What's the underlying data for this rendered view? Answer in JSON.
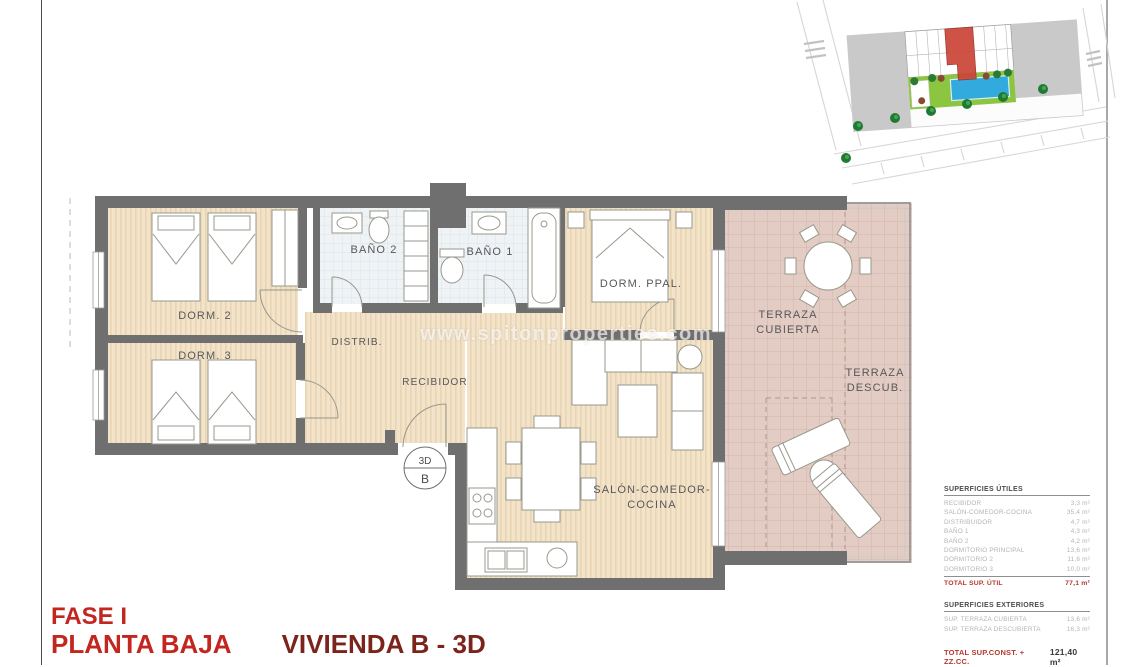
{
  "titles": {
    "fase": "FASE I",
    "planta": "PLANTA BAJA",
    "vivienda": "VIVIENDA B - 3D"
  },
  "watermark": "www.spitonproperties.com",
  "marker": {
    "top": "3D",
    "bottom": "B"
  },
  "rooms": {
    "dorm2": "DORM. 2",
    "dorm3": "DORM. 3",
    "bano2": "BAÑO 2",
    "bano1": "BAÑO 1",
    "dorm_ppal": "DORM. PPAL.",
    "distrib": "DISTRIB.",
    "recibidor": "RECIBIDOR",
    "salon1": "SALÓN-COMEDOR-",
    "salon2": "COCINA",
    "terraza_cubierta1": "TERRAZA",
    "terraza_cubierta2": "CUBIERTA",
    "terraza_descub1": "TERRAZA",
    "terraza_descub2": "DESCUB."
  },
  "areas": {
    "utiles_title": "SUPERFICIES ÚTILES",
    "utiles": [
      {
        "label": "RECIBIDOR",
        "value": "3,3 m²"
      },
      {
        "label": "SALÓN-COMEDOR-COCINA",
        "value": "35,4 m²"
      },
      {
        "label": "DISTRIBUIDOR",
        "value": "4,7 m²"
      },
      {
        "label": "BAÑO 1",
        "value": "4,3 m²"
      },
      {
        "label": "BAÑO 2",
        "value": "4,2 m²"
      },
      {
        "label": "DORMITORIO PRINCIPAL",
        "value": "13,6 m²"
      },
      {
        "label": "DORMITORIO 2",
        "value": "11,6 m²"
      },
      {
        "label": "DORMITORIO 3",
        "value": "10,0 m²"
      }
    ],
    "total_util_label": "TOTAL SUP. ÚTIL",
    "total_util_value": "77,1 m²",
    "exteriores_title": "SUPERFICIES EXTERIORES",
    "exteriores": [
      {
        "label": "SUP. TERRAZA CUBIERTA",
        "value": "13,6 m²"
      },
      {
        "label": "SUP. TERRAZA DESCUBIERTA",
        "value": "16,3 m²"
      }
    ],
    "total_const_label": "TOTAL SUP.CONST. + ZZ.CC.",
    "total_const_value": "121,40 m²"
  },
  "colors": {
    "title_red": "#c3251f",
    "title_dark_red": "#7c241b",
    "total_red": "#b23a31",
    "wall_gray": "#6f6f6f",
    "wood_floor": "#f2e3c9",
    "bath_tile": "#eff3f5",
    "terrace_tile": "#e3ccc3",
    "site_highlight_red": "#cb4437",
    "garden_green": "#8cc540",
    "pool_blue": "#33aadd"
  }
}
